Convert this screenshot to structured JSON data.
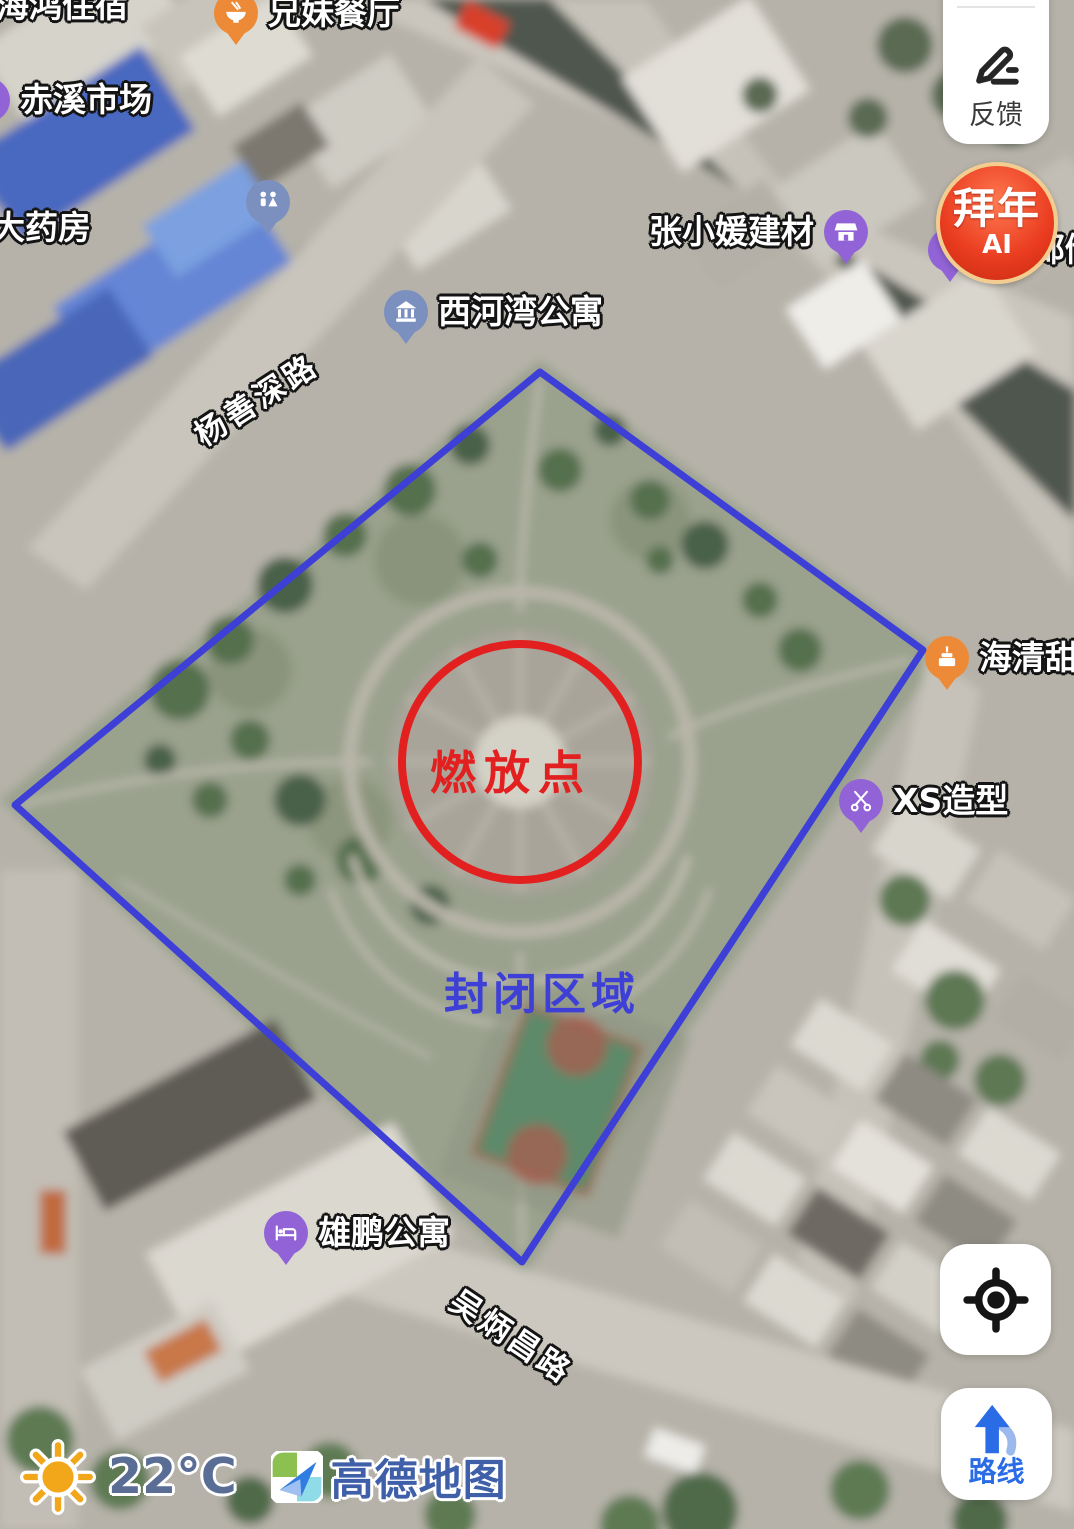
{
  "ui": {
    "feedback_button": {
      "label": "反馈",
      "icon": "pencil-icon"
    },
    "ai_badge": {
      "title": "拜年",
      "subtitle": "AI"
    },
    "route_button": {
      "label": "路线",
      "icon": "navigation-arrow-icon"
    },
    "locate_button": {
      "icon": "crosshair-icon"
    },
    "weather": {
      "temperature": "22°C",
      "icon": "sun-icon"
    },
    "brand": "高德地图"
  },
  "map": {
    "annotations": {
      "burn_point_label": "燃放点",
      "closed_area_label": "封闭区域"
    },
    "roads": [
      {
        "name": "杨善深路"
      },
      {
        "name": "吴炳昌路"
      }
    ],
    "pois": [
      {
        "name": "海鸿住宿",
        "type": "text-label",
        "partially_visible": true
      },
      {
        "name": "兄妹餐厅",
        "pin": "orange",
        "icon": "restaurant-icon"
      },
      {
        "name": "赤溪市场",
        "pin": "purple",
        "icon": "market-icon",
        "partially_visible": true
      },
      {
        "name": "大药房",
        "type": "text-label",
        "partially_visible": true
      },
      {
        "name": "",
        "pin": "slate",
        "icon": "restroom-icon"
      },
      {
        "name": "西河湾公寓",
        "pin": "slate",
        "icon": "building-icon"
      },
      {
        "name": "张小媛建材",
        "pin": "purple",
        "icon": "shop-icon"
      },
      {
        "name": "邮储银行",
        "pin": "purple",
        "partially_visible": true
      },
      {
        "name": "海清甜品",
        "pin": "orange",
        "icon": "cake-icon",
        "partially_visible": true
      },
      {
        "name": "XS造型",
        "pin": "purple",
        "icon": "scissors-icon"
      },
      {
        "name": "雄鹏公寓",
        "pin": "purple",
        "icon": "bed-icon"
      }
    ],
    "colors": {
      "pin_orange": "#ed8a37",
      "pin_purple": "#9163d6",
      "pin_slate": "#7c90c0",
      "boundary_blue": "#3d3fd6",
      "burn_circle_red": "#e32020",
      "brand_blue": "#3f5fa8",
      "route_blue": "#2a6be6",
      "badge_red": "#ea3c20"
    }
  }
}
